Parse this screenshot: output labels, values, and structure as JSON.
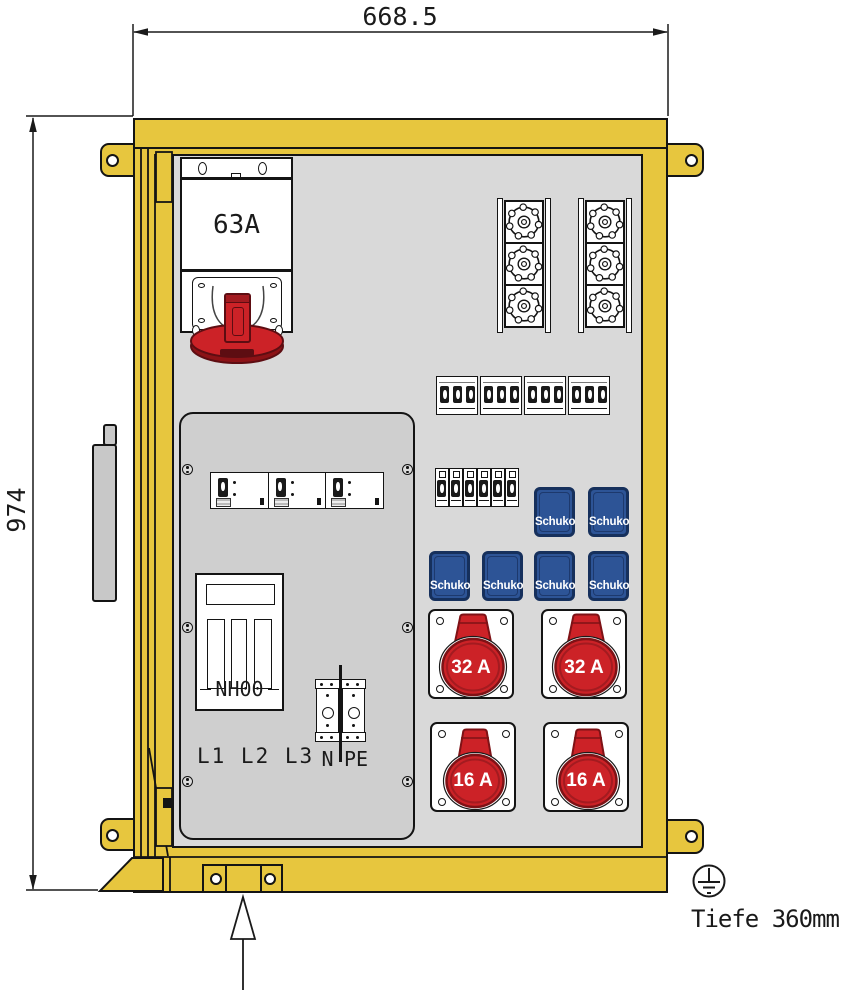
{
  "dimensions": {
    "width": "668.5",
    "height": "974",
    "depth": "Tiefe 360mm"
  },
  "inlet": {
    "rating": "63A"
  },
  "nh_fuse": {
    "label": "NH00"
  },
  "wiring_labels": {
    "phases": "L1 L2 L3",
    "neutral": "N",
    "protective_earth": "PE"
  },
  "sockets": {
    "schuko_label": "Schuko",
    "cee": [
      {
        "rating": "32 A"
      },
      {
        "rating": "32 A"
      },
      {
        "rating": "16 A"
      },
      {
        "rating": "16 A"
      }
    ]
  },
  "colors": {
    "enclosure_yellow": "#e7c63e",
    "wall_gray": "#d9d9d9",
    "panel_gray": "#cfcfcf",
    "schuko_blue": "#2d5496",
    "cee_red": "#cc2227",
    "line": "#1a1a1a"
  },
  "icons": {
    "earth_symbol": "earth-ground-symbol",
    "mounting_arrow": "up-arrow",
    "fuse_cap": "round-fuse-cap",
    "mounting_hole": "circle-hole"
  }
}
